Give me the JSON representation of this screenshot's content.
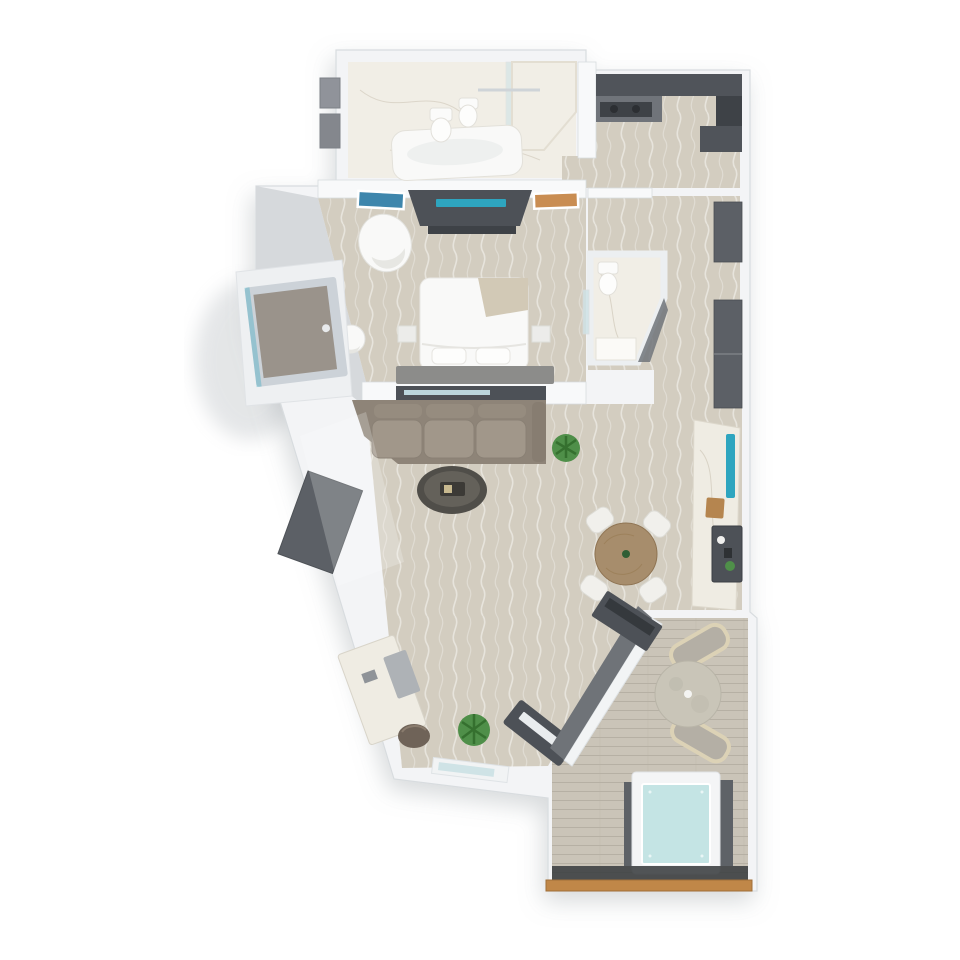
{
  "meta": {
    "view": "top-down-3d-floor-plan",
    "canvas": {
      "width": 960,
      "height": 960
    },
    "background": "#ffffff"
  },
  "palette": {
    "wall": "#f3f4f6",
    "wallStroke": "#d8dcdf",
    "wallSide": "#d6d9dc",
    "innerWall": "#f8f9fa",
    "carpet": "#d3cdc0",
    "carpetGrain": "#ffffff",
    "marble": "#f1eee6",
    "marbleVein": "#d9d3c6",
    "deck": "#cac4b8",
    "deckLine": "#b6b0a4",
    "cabinet": "#50545a",
    "cabinetDark": "#3e4247",
    "counter": "#70747a",
    "closet": "#5c6066",
    "sofa": "#8e8478",
    "sofaCushion": "#a1978a",
    "bedWhite": "#f9f9f8",
    "throw": "#d2c9b6",
    "headboard": "#8c8c8a",
    "teal": "#2ea5bf",
    "tealLight": "#bcd7de",
    "artLeft": "#3e86ac",
    "artRight": "#c98d52",
    "consoleDark": "#4d5157",
    "screenLight": "#e9ecee",
    "coffeeTable": "#504e49",
    "coffeeTableTop": "#64615a",
    "tableWood": "#a78d6c",
    "chairWhite": "#f1f0ec",
    "stoneTable": "#c9c5b8",
    "loungeFrame": "#dcd2b6",
    "loungeCushion": "#b4afa5",
    "water": "#c4e4e4",
    "tubPanel": "#5e6267",
    "glassDark": "#3a3d40",
    "woodTrim": "#c08748",
    "plant": "#4f8f49",
    "plantDark": "#35702f",
    "doorPanel": "#9a938b",
    "doorFrame": "#c9d0d6",
    "privacyWall": "#6f7378",
    "deskMarble": "#efece3",
    "stool": "#6f6358",
    "shadow": "#a7adb3",
    "glassPane": "#cfe3e6"
  },
  "scene": {
    "rooms": [
      {
        "id": "master-bathroom",
        "floor": "marble"
      },
      {
        "id": "kitchenette",
        "floor": "carpet"
      },
      {
        "id": "bedroom",
        "floor": "carpet"
      },
      {
        "id": "water-closet",
        "floor": "marble"
      },
      {
        "id": "living-dining",
        "floor": "carpet"
      },
      {
        "id": "terrace",
        "floor": "deck"
      }
    ],
    "furniture": [
      "bathtub",
      "toilet",
      "bidet",
      "shower-enclosure",
      "storage-shelves",
      "kitchen-cabinets",
      "cooktop",
      "wardrobe-closets",
      "bed",
      "pillows",
      "headboard",
      "folded-throw",
      "armchair",
      "side-stool",
      "tv-console",
      "wall-art-left",
      "wall-art-right",
      "nightstands",
      "sofa",
      "coffee-table",
      "potted-plant-living",
      "living-console",
      "dining-table",
      "dining-chairs",
      "bar-counter",
      "teal-backsplash",
      "cutting-board",
      "minibar-tray",
      "wc-toilet",
      "wc-vanity",
      "vanity-desk",
      "vanity-stool",
      "wall-mirror",
      "potted-plant-entry",
      "media-console",
      "outdoor-console",
      "entry-door",
      "lounge-chair-north",
      "lounge-chair-south",
      "terrace-table",
      "hot-tub",
      "privacy-screen",
      "terrace-door",
      "wood-edge-trim"
    ]
  }
}
